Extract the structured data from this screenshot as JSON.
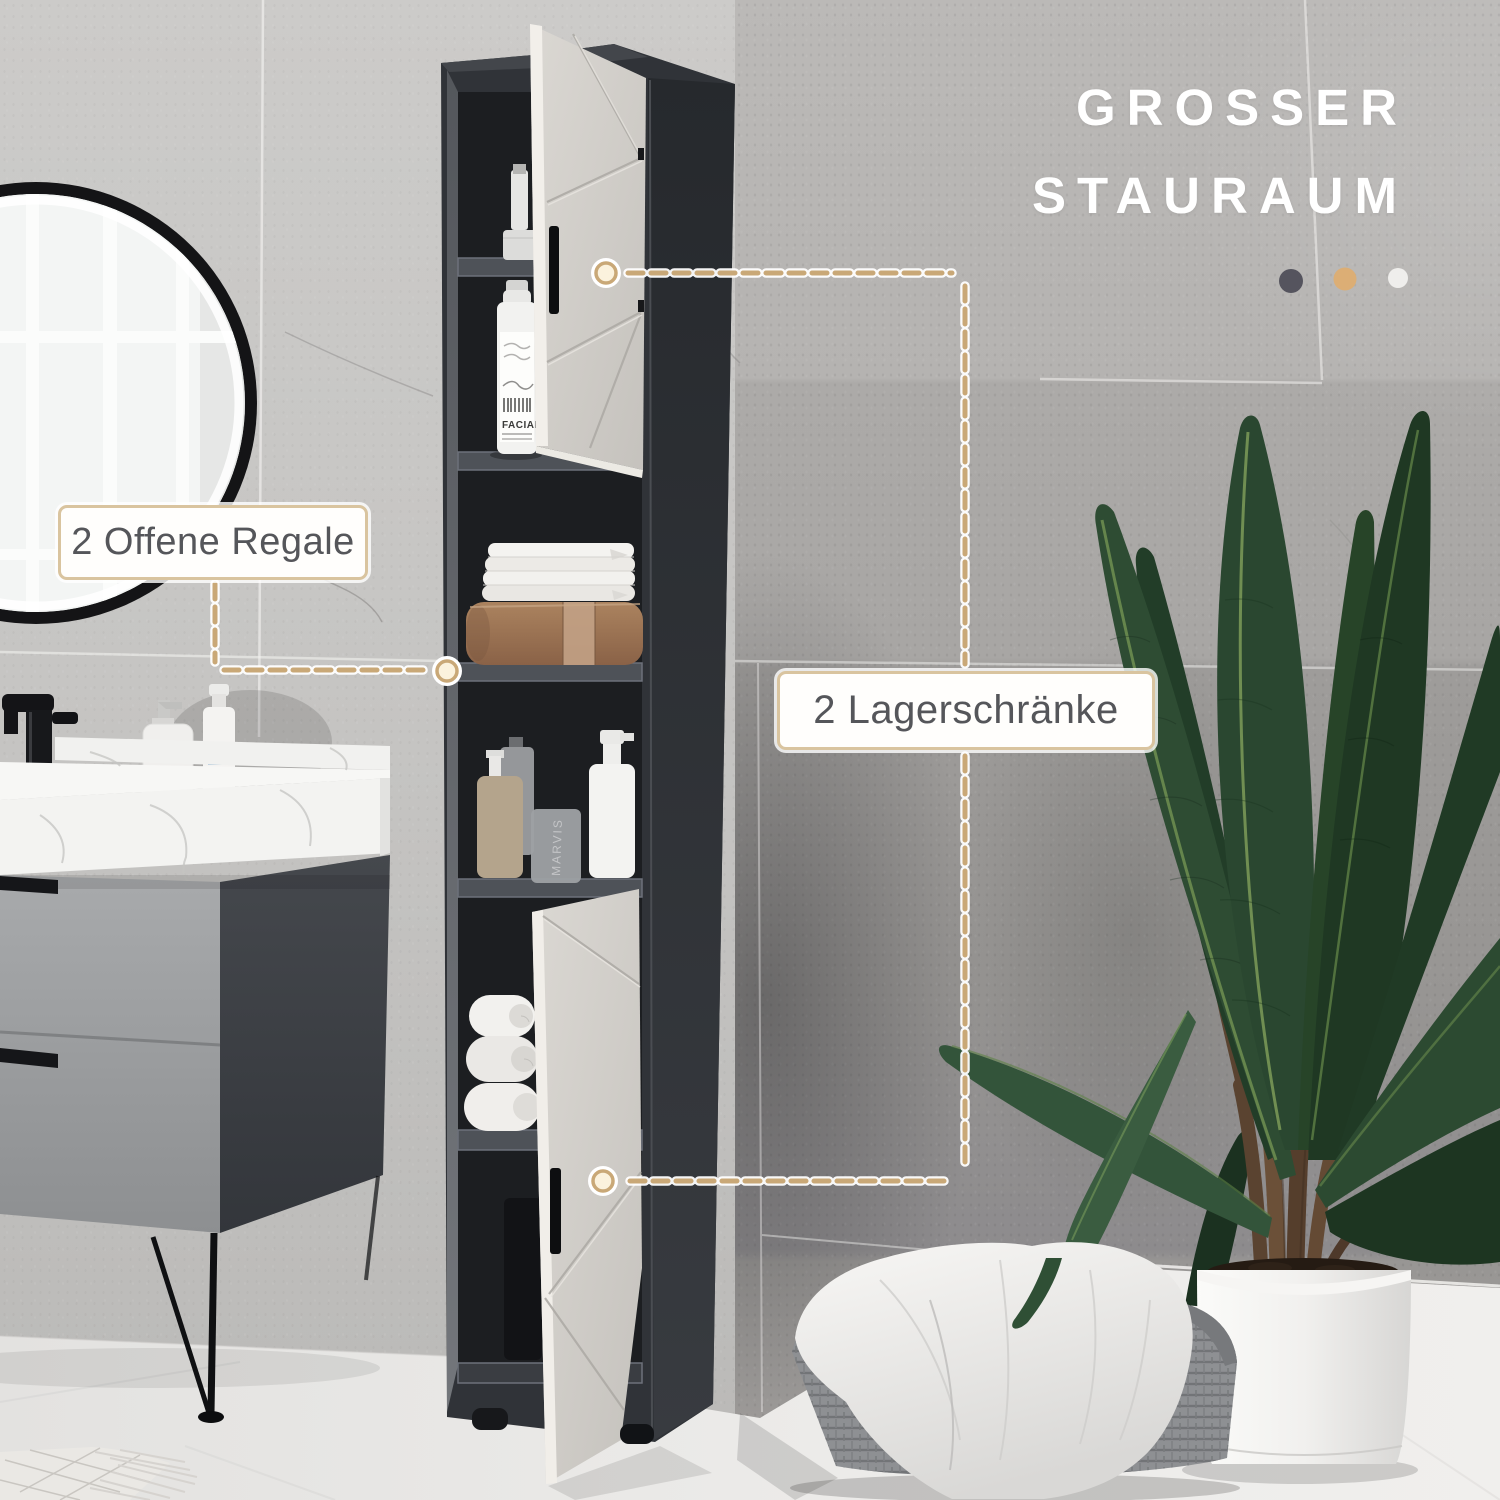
{
  "annotations": {
    "headline": {
      "line1": "GROSSER",
      "line2": "STAURAUM",
      "color": "#ffffff"
    },
    "color_swatches": [
      {
        "name": "anthracite",
        "color": "#55545e"
      },
      {
        "name": "sand",
        "color": "#dcae75"
      },
      {
        "name": "white",
        "color": "#efeeec"
      }
    ],
    "callouts": [
      {
        "id": "open-shelves",
        "label": "2 Offene Regale"
      },
      {
        "id": "storage-cabinets",
        "label": "2 Lagerschränke"
      }
    ],
    "accent_color": "#c9a877"
  },
  "scene_text": {
    "cleanser_label": "FACIAL",
    "toothpaste_label": "MARVIS"
  }
}
